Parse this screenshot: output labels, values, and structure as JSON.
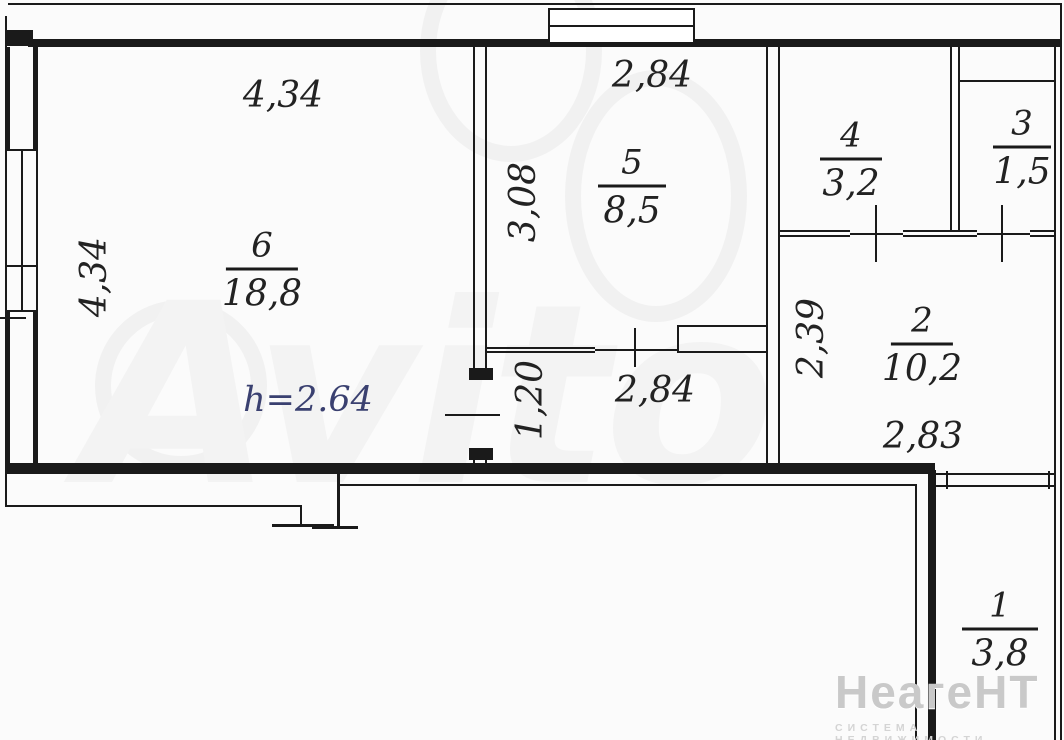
{
  "plan": {
    "height_note": "h=2.64",
    "rooms": {
      "r6": {
        "number": "6",
        "area": "18,8"
      },
      "r5": {
        "number": "5",
        "area": "8,5"
      },
      "r4": {
        "number": "4",
        "area": "3,2"
      },
      "r3": {
        "number": "3",
        "area": "1,5"
      },
      "r2": {
        "number": "2",
        "area": "10,2"
      },
      "r1": {
        "number": "1",
        "area": "3,8"
      }
    },
    "dims": {
      "room6_top": "4,34",
      "room6_left": "4,34",
      "room5_top": "2,84",
      "room5_side": "3,08",
      "corridor_top": "2,84",
      "corridor_side": "1,20",
      "hall_side": "2,39",
      "room2_width": "2,83"
    },
    "colors": {
      "line": "#1a1a1a",
      "height_note": "#3a4070",
      "watermark": "#c9c9c9"
    }
  },
  "watermarks": {
    "center_brand": "Avito",
    "bottom_right_title": "НеагеНТ",
    "bottom_right_subtitle": "СИСТЕМА НЕДВИЖИМОСТИ"
  }
}
